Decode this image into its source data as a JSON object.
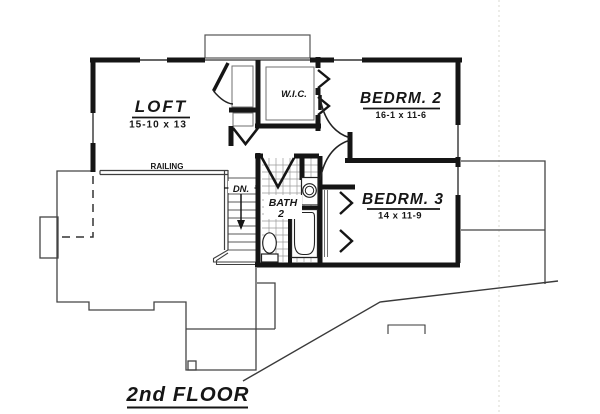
{
  "drawing": {
    "title": "2nd FLOOR",
    "rooms": {
      "loft": {
        "name": "LOFT",
        "dims": "15-10 x 13"
      },
      "wic": {
        "name": "W.I.C."
      },
      "bedrm2": {
        "name": "BEDRM.  2",
        "dims": "16-1 x 11-6"
      },
      "bedrm3": {
        "name": "BEDRM.  3",
        "dims": "14 x 11-9"
      },
      "bath2": {
        "name": "BATH",
        "number": "2"
      }
    },
    "labels": {
      "railing": "RAILING",
      "stairs_down": "DN."
    },
    "colors": {
      "wall_line": "#151515",
      "thin_line": "#444444",
      "tile_grid": "#9a9a9a",
      "background": "#ffffff"
    }
  }
}
